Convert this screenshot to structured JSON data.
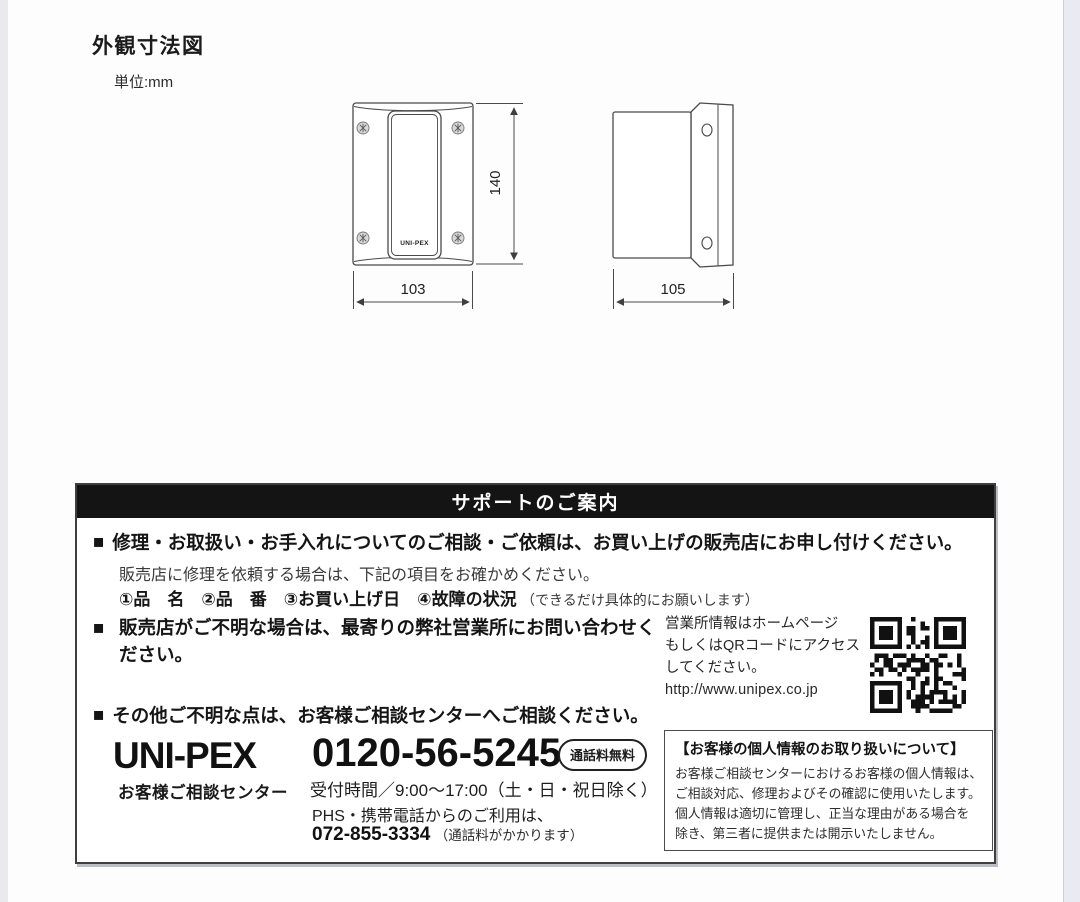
{
  "page": {
    "title": "外観寸法図",
    "unit_label": "単位:mm"
  },
  "drawing": {
    "front_view": {
      "logo": "UNI-PEX",
      "width_mm": "103",
      "height_mm": "140"
    },
    "side_view": {
      "depth_mm": "105"
    }
  },
  "support": {
    "bullet": "■",
    "header": "サポートのご案内",
    "section1": {
      "line1": "修理・お取扱い・お手入れについてのご相談・ご依頼は、お買い上げの販売店にお申し付けください。",
      "line2": "販売店に修理を依頼する場合は、下記の項目をお確かめください。",
      "items_bold": "①品　名　②品　番　③お買い上げ日　④故障の状況",
      "items_note": "（できるだけ具体的にお願いします）"
    },
    "section2": {
      "text": "販売店がご不明な場合は、最寄りの弊社営業所にお問い合わせください。",
      "web_info_line1": "営業所情報はホームページ",
      "web_info_line2": "もしくはQRコードにアクセス",
      "web_info_line3": "してください。",
      "url": "http://www.unipex.co.jp"
    },
    "section3": {
      "text": "その他ご不明な点は、お客様ご相談センターへご相談ください。",
      "brand": "UNI-PEX",
      "brand_sub": "お客様ご相談センター",
      "phone_tollfree": "0120-56-5245",
      "tollfree_badge": "通話料無料",
      "hours": "受付時間／9:00～17:00（土・日・祝日除く）",
      "mobile_note": "PHS・携帯電話からのご利用は、",
      "phone_mobile": "072-855-3334",
      "mobile_fee_note": "（通話料がかかります）",
      "privacy": {
        "title": "【お客様の個人情報のお取り扱いについて】",
        "body1": "お客様ご相談センターにおけるお客様の個人情報は、",
        "body2": "ご相談対応、修理およびその確認に使用いたします。",
        "body3": "個人情報は適切に管理し、正当な理由がある場合を",
        "body4": "除き、第三者に提供または開示いたしません。"
      }
    }
  },
  "colors": {
    "header_bg": "#141414",
    "line_color": "#4a4a4a",
    "text": "#1f1f1f"
  }
}
